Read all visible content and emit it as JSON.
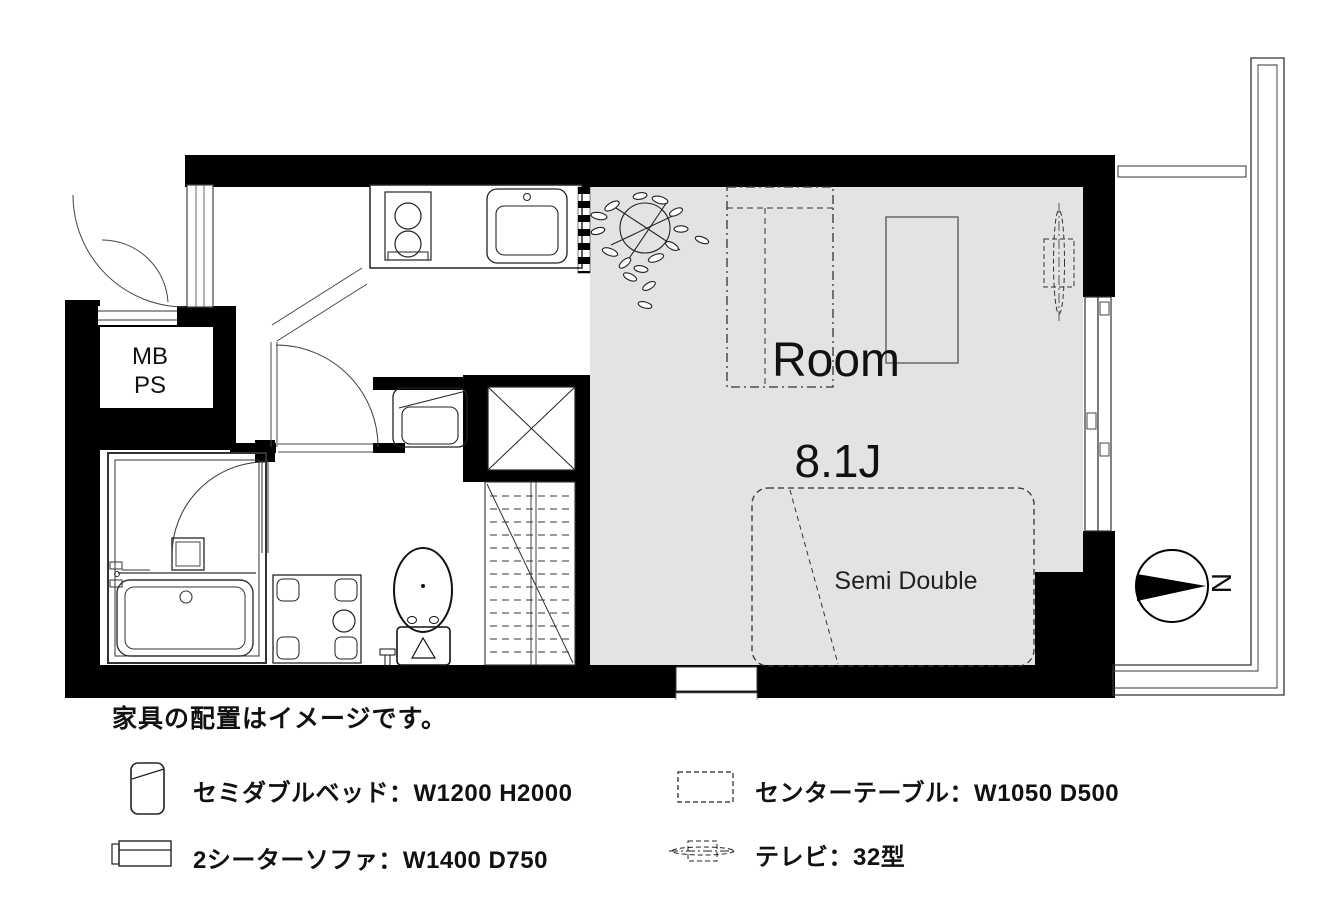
{
  "floor_plan": {
    "mb_label": "MB",
    "ps_label": "PS",
    "room_name": "Room",
    "room_size": "8.1J",
    "bed_size_label": "Semi Double",
    "compass_north": "N"
  },
  "caption": "家具の配置はイメージです。",
  "legend": {
    "bed": "セミダブルベッド：W1200 H2000",
    "sofa": "2シーターソファ：W1400 D750",
    "table": "センターテーブル：W1050 D500",
    "tv": "テレビ：32型"
  },
  "colors": {
    "wall": "#000000",
    "floor": "#e3e3e3",
    "line": "#333333",
    "text": "#111111",
    "background": "#ffffff"
  }
}
